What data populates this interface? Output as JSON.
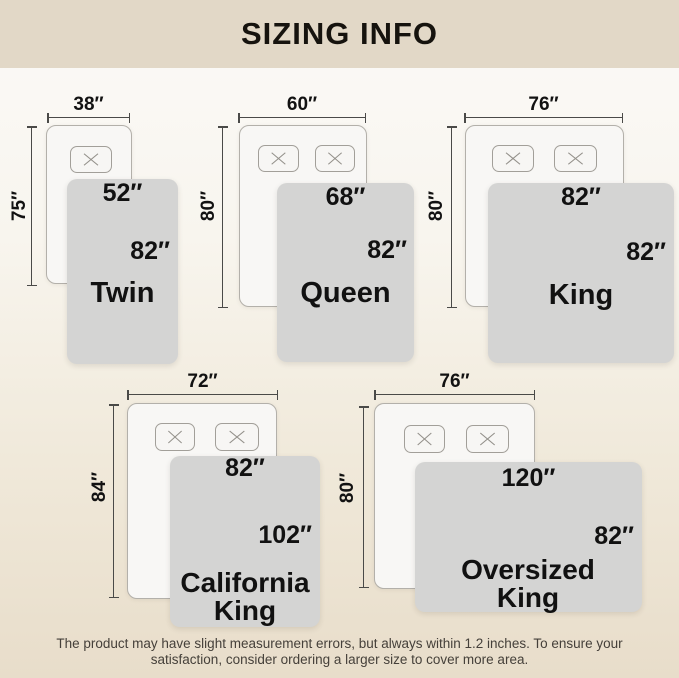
{
  "header": {
    "title": "SIZING INFO"
  },
  "diagrams": [
    {
      "name": "Twin",
      "bed_width": "38″",
      "bed_length": "75″",
      "blanket_width": "52″",
      "blanket_length": "82″"
    },
    {
      "name": "Queen",
      "bed_width": "60″",
      "bed_length": "80″",
      "blanket_width": "68″",
      "blanket_length": "82″"
    },
    {
      "name": "King",
      "bed_width": "76″",
      "bed_length": "80″",
      "blanket_width": "82″",
      "blanket_length": "82″"
    },
    {
      "name": "California King",
      "bed_width": "72″",
      "bed_length": "84″",
      "blanket_width": "82″",
      "blanket_length": "102″"
    },
    {
      "name": "Oversized King",
      "bed_width": "76″",
      "bed_length": "80″",
      "blanket_width": "120″",
      "blanket_length": "82″"
    }
  ],
  "footer": {
    "note": "The product may have slight measurement errors, but always within 1.2 inches. To ensure your satisfaction, consider ordering a larger size to cover more area."
  },
  "colors": {
    "header_bg": "#e2d8c7",
    "page_bottom": "#e8ddca",
    "blanket": "#d4d4d3",
    "bed": "#f8f7f5",
    "label_text": "#111111"
  }
}
